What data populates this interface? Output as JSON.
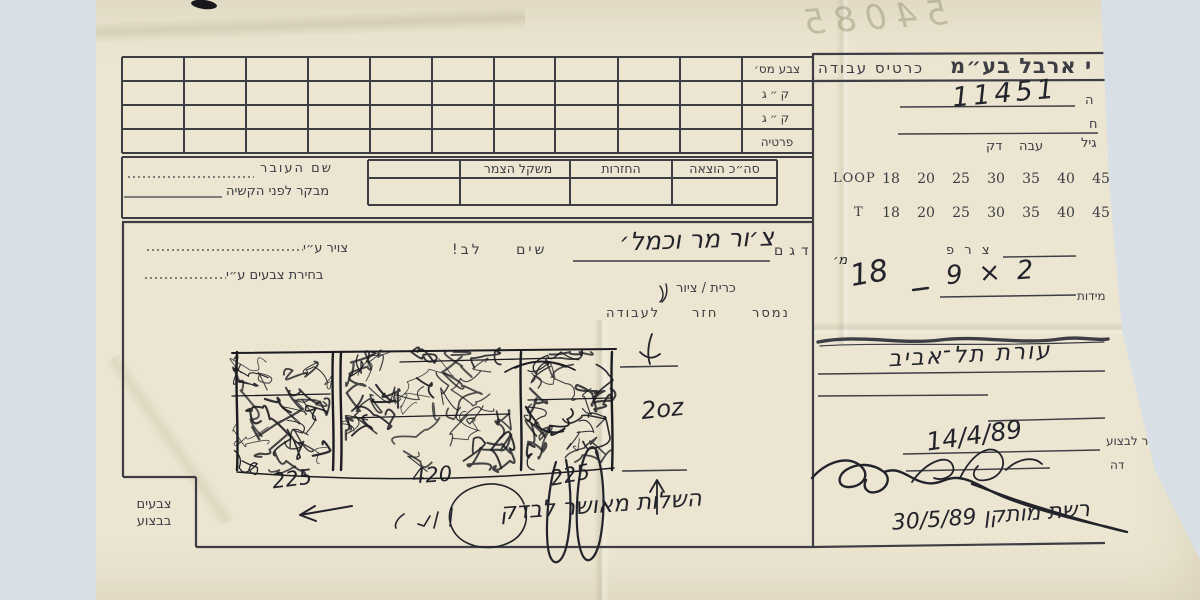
{
  "colors": {
    "backdrop": "#d8dfe6",
    "paper": "#ebe5d1",
    "print_ink": "#3d3d44",
    "hand_ink": "#23232b",
    "pencil": "#85815f"
  },
  "header": {
    "pencil_note": "54085",
    "card_title": "כרטיס עבודה",
    "company_name": "י ארבל בע״מ",
    "order_number": "11451",
    "field_fragment_top": "ה",
    "field_fragment_bottom": "ח"
  },
  "color_table": {
    "row_labels": [
      "צבע מס׳",
      "ק״ג",
      "ק״ג",
      "פרטיה"
    ]
  },
  "mid_section": {
    "worker_name_label": "שם העובר",
    "inspector_label": "מבקר לפני הקשיה",
    "col_wool_weight": "משקל הצמר",
    "col_returns": "החזרות",
    "col_total_issue": "סה״כ הוצאה"
  },
  "gauge": {
    "grade_label": "גיל",
    "thick_label": "עבה",
    "thin_label": "דק",
    "loop_label": "LOOP",
    "t_label": "T",
    "loop_values": [
      "18",
      "20",
      "25",
      "30",
      "35",
      "40",
      "45"
    ],
    "t_values": [
      "18",
      "20",
      "25",
      "30",
      "35",
      "40",
      "45"
    ]
  },
  "body": {
    "drawn_by_label": "צויר ע״י",
    "color_pick_label": "בחירת צבעים ע״י",
    "model_label": "דגם",
    "model_value_hw": "צ׳ור מר וכמל׳",
    "attention_label": "שים לב!",
    "cut_draw_label": "כרית / ציור",
    "col_delivered": "נמסר",
    "col_returned": "חזר",
    "col_to_work": "לעבודה",
    "weight_note_hw": "2oz",
    "panel_width_left": "225",
    "panel_width_center": "420",
    "panel_width_right": "225",
    "approval_note_hw": "השלות מאושר לבדק",
    "colors_in_progress_line1": "צבעים",
    "colors_in_progress_line2": "בבצוע"
  },
  "right_panel": {
    "tsaraf_label": "צ ר פ",
    "size_hw": "9 × 2",
    "size_total_hw": "18",
    "size_unit_hw": "מ׳",
    "sizes_label": "מידות",
    "client_note_hw": "עורת תל־אביב",
    "delivery_label_fragment": "ר לבצוע",
    "delivery_date_hw": "14/4/89",
    "finish_label_fragment": "דה",
    "net_installed_hw": "רשת מותקן 30/5/89"
  }
}
